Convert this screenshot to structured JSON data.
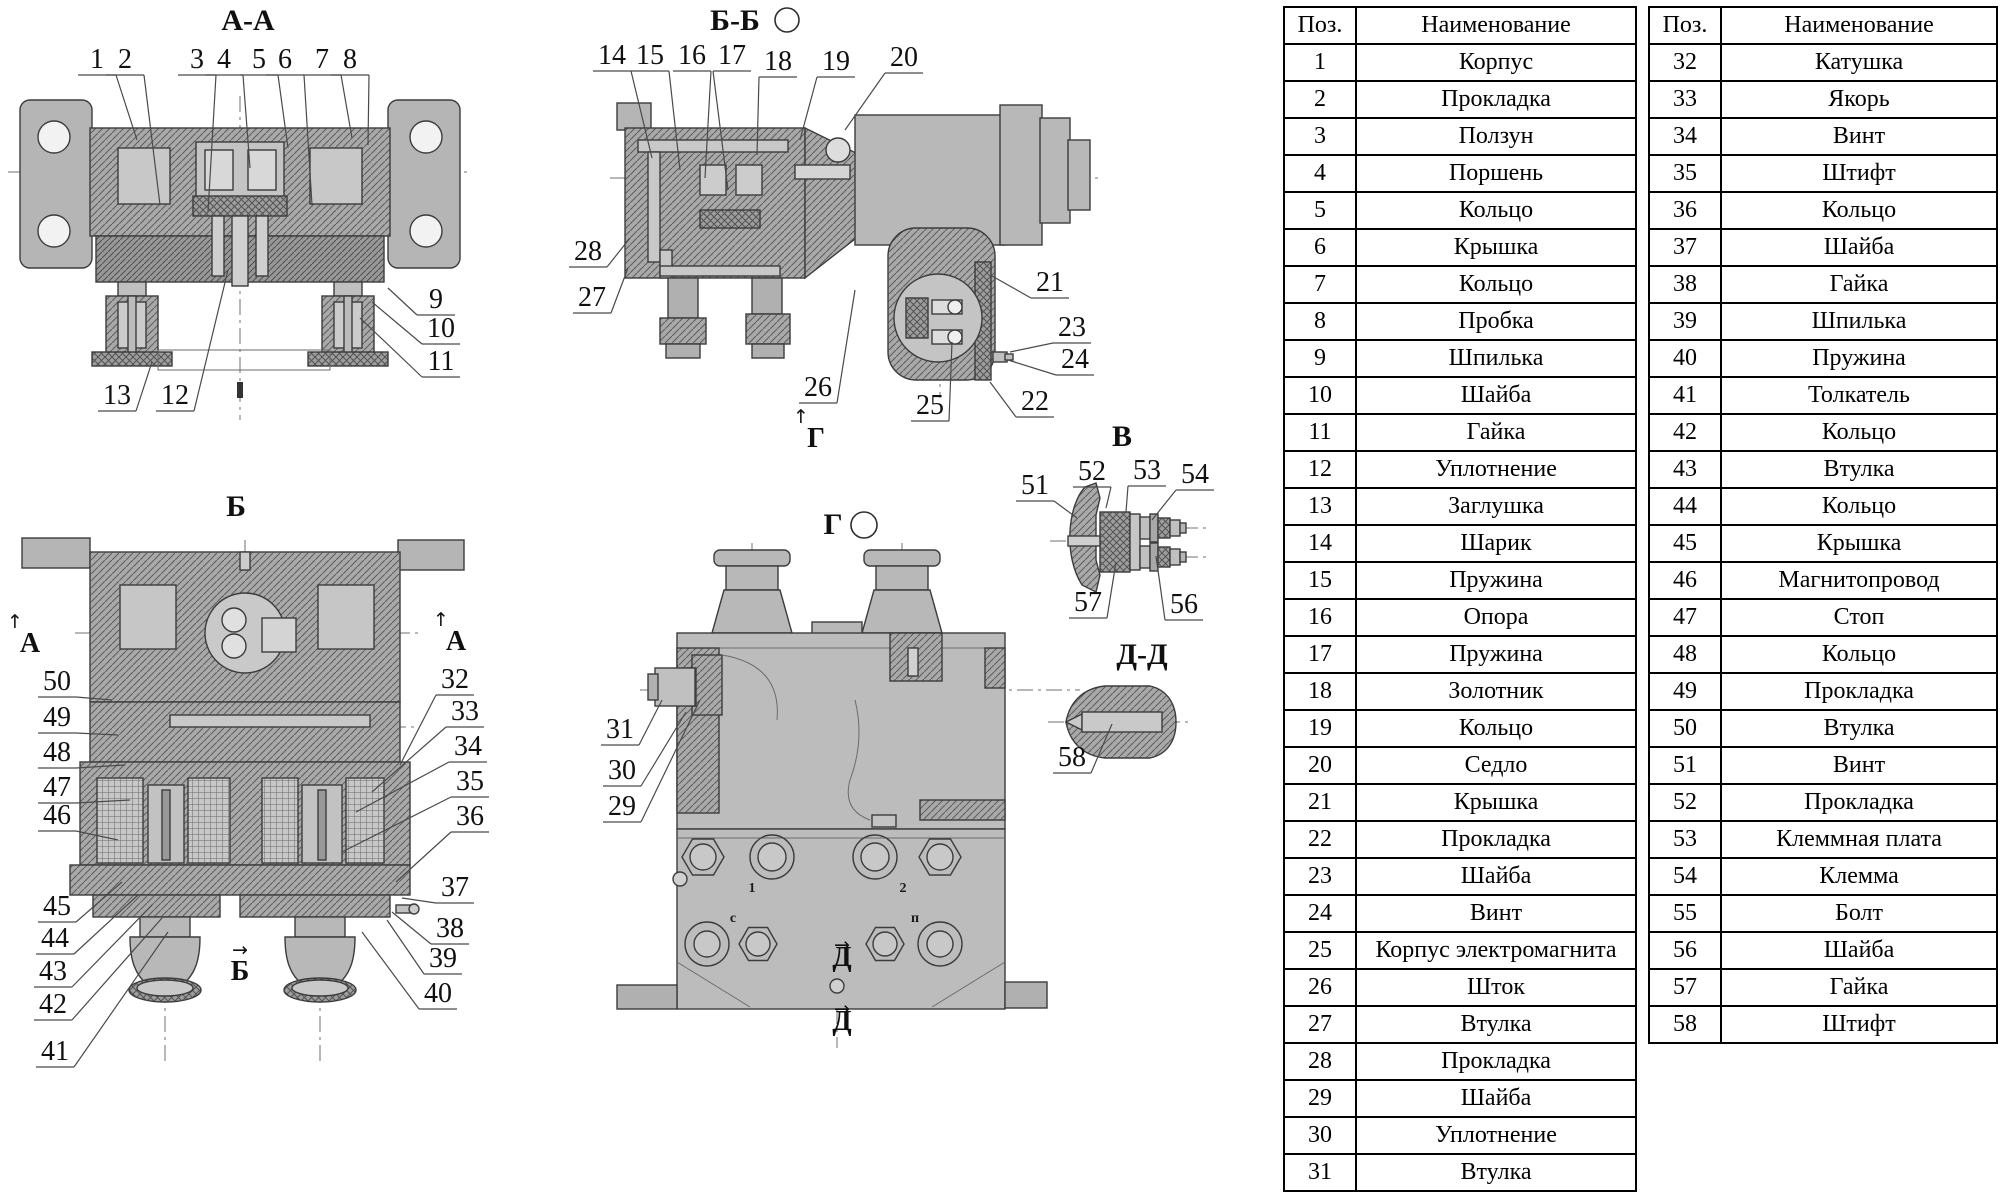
{
  "drawing": {
    "views": [
      {
        "id": "aa",
        "title": "А-А",
        "tx": 248,
        "ty": 30,
        "circle": null,
        "callouts": [
          {
            "n": "1",
            "x": 97,
            "y": 68,
            "px": 137,
            "py": 140
          },
          {
            "n": "2",
            "x": 125,
            "y": 68,
            "px": 160,
            "py": 205
          },
          {
            "n": "3",
            "x": 197,
            "y": 68,
            "px": 208,
            "py": 212
          },
          {
            "n": "4",
            "x": 224,
            "y": 68,
            "px": 250,
            "py": 168
          },
          {
            "n": "5",
            "x": 259,
            "y": 68,
            "px": 288,
            "py": 148
          },
          {
            "n": "6",
            "x": 285,
            "y": 68,
            "px": 312,
            "py": 205
          },
          {
            "n": "7",
            "x": 322,
            "y": 68,
            "px": 352,
            "py": 138
          },
          {
            "n": "8",
            "x": 350,
            "y": 68,
            "px": 368,
            "py": 145
          },
          {
            "n": "9",
            "x": 436,
            "y": 308,
            "px": 388,
            "py": 288
          },
          {
            "n": "10",
            "x": 441,
            "y": 337,
            "px": 372,
            "py": 302
          },
          {
            "n": "11",
            "x": 441,
            "y": 370,
            "px": 360,
            "py": 318
          },
          {
            "n": "13",
            "x": 117,
            "y": 404,
            "px": 152,
            "py": 362
          },
          {
            "n": "12",
            "x": 175,
            "y": 404,
            "px": 228,
            "py": 270
          }
        ]
      },
      {
        "id": "bb",
        "title": "Б-Б",
        "tx": 735,
        "ty": 30,
        "circle": {
          "x": 787,
          "y": 20,
          "r": 12
        },
        "callouts": [
          {
            "n": "14",
            "x": 612,
            "y": 64,
            "px": 652,
            "py": 158
          },
          {
            "n": "15",
            "x": 650,
            "y": 64,
            "px": 680,
            "py": 170
          },
          {
            "n": "16",
            "x": 692,
            "y": 64,
            "px": 705,
            "py": 178
          },
          {
            "n": "17",
            "x": 732,
            "y": 64,
            "px": 728,
            "py": 190
          },
          {
            "n": "18",
            "x": 778,
            "y": 70,
            "px": 757,
            "py": 155
          },
          {
            "n": "19",
            "x": 836,
            "y": 70,
            "px": 800,
            "py": 140
          },
          {
            "n": "20",
            "x": 904,
            "y": 66,
            "px": 845,
            "py": 130
          },
          {
            "n": "28",
            "x": 588,
            "y": 260,
            "px": 630,
            "py": 238
          },
          {
            "n": "27",
            "x": 592,
            "y": 306,
            "px": 628,
            "py": 268
          },
          {
            "n": "21",
            "x": 1050,
            "y": 291,
            "px": 992,
            "py": 276
          },
          {
            "n": "23",
            "x": 1072,
            "y": 336,
            "px": 1010,
            "py": 352
          },
          {
            "n": "24",
            "x": 1075,
            "y": 368,
            "px": 1008,
            "py": 360
          },
          {
            "n": "22",
            "x": 1035,
            "y": 410,
            "px": 990,
            "py": 382
          },
          {
            "n": "26",
            "x": 818,
            "y": 396,
            "px": 855,
            "py": 290
          },
          {
            "n": "25",
            "x": 930,
            "y": 414,
            "px": 952,
            "py": 342
          }
        ]
      },
      {
        "id": "b",
        "title": "Б",
        "tx": 236,
        "ty": 516,
        "circle": null,
        "callouts": [
          {
            "n": "50",
            "x": 57,
            "y": 690,
            "px": 112,
            "py": 700
          },
          {
            "n": "49",
            "x": 57,
            "y": 726,
            "px": 118,
            "py": 735
          },
          {
            "n": "48",
            "x": 57,
            "y": 761,
            "px": 125,
            "py": 765
          },
          {
            "n": "47",
            "x": 57,
            "y": 796,
            "px": 130,
            "py": 800
          },
          {
            "n": "46",
            "x": 57,
            "y": 824,
            "px": 118,
            "py": 840
          },
          {
            "n": "45",
            "x": 57,
            "y": 915,
            "px": 122,
            "py": 882
          },
          {
            "n": "44",
            "x": 55,
            "y": 947,
            "px": 138,
            "py": 895
          },
          {
            "n": "43",
            "x": 53,
            "y": 980,
            "px": 152,
            "py": 905
          },
          {
            "n": "42",
            "x": 53,
            "y": 1013,
            "px": 162,
            "py": 918
          },
          {
            "n": "41",
            "x": 55,
            "y": 1060,
            "px": 168,
            "py": 932
          },
          {
            "n": "32",
            "x": 455,
            "y": 688,
            "px": 400,
            "py": 765
          },
          {
            "n": "33",
            "x": 465,
            "y": 720,
            "px": 372,
            "py": 792
          },
          {
            "n": "34",
            "x": 468,
            "y": 755,
            "px": 356,
            "py": 812
          },
          {
            "n": "35",
            "x": 470,
            "y": 790,
            "px": 342,
            "py": 852
          },
          {
            "n": "36",
            "x": 470,
            "y": 825,
            "px": 396,
            "py": 882
          },
          {
            "n": "37",
            "x": 455,
            "y": 896,
            "px": 402,
            "py": 898
          },
          {
            "n": "38",
            "x": 450,
            "y": 937,
            "px": 392,
            "py": 912
          },
          {
            "n": "39",
            "x": 443,
            "y": 967,
            "px": 387,
            "py": 920
          },
          {
            "n": "40",
            "x": 438,
            "y": 1002,
            "px": 362,
            "py": 932
          }
        ]
      },
      {
        "id": "g",
        "title": "Г",
        "tx": 833,
        "ty": 534,
        "circle": {
          "x": 864,
          "y": 525,
          "r": 13
        },
        "callouts": [
          {
            "n": "31",
            "x": 620,
            "y": 738,
            "px": 662,
            "py": 700
          },
          {
            "n": "30",
            "x": 622,
            "y": 779,
            "px": 686,
            "py": 712
          },
          {
            "n": "29",
            "x": 622,
            "y": 815,
            "px": 700,
            "py": 700
          }
        ]
      },
      {
        "id": "v",
        "title": "В",
        "tx": 1122,
        "ty": 446,
        "circle": null,
        "callouts": [
          {
            "n": "51",
            "x": 1035,
            "y": 494,
            "px": 1077,
            "py": 518
          },
          {
            "n": "52",
            "x": 1092,
            "y": 480,
            "px": 1106,
            "py": 508
          },
          {
            "n": "53",
            "x": 1147,
            "y": 479,
            "px": 1126,
            "py": 512
          },
          {
            "n": "54",
            "x": 1195,
            "y": 483,
            "px": 1152,
            "py": 520
          },
          {
            "n": "57",
            "x": 1088,
            "y": 611,
            "px": 1116,
            "py": 562
          },
          {
            "n": "56",
            "x": 1184,
            "y": 613,
            "px": 1156,
            "py": 556
          }
        ]
      },
      {
        "id": "dd",
        "title": "Д-Д",
        "tx": 1142,
        "ty": 664,
        "circle": null,
        "callouts": [
          {
            "n": "58",
            "x": 1072,
            "y": 766,
            "px": 1112,
            "py": 724
          }
        ]
      }
    ],
    "markers": [
      {
        "label": "А",
        "x": 30,
        "y": 652,
        "dir": "up",
        "size": 28
      },
      {
        "label": "А",
        "x": 456,
        "y": 650,
        "dir": "up",
        "size": 28
      },
      {
        "label": "Б",
        "x": 240,
        "y": 980,
        "dir": "right",
        "size": 28
      },
      {
        "label": "Г",
        "x": 816,
        "y": 447,
        "dir": "up",
        "size": 28
      },
      {
        "label": "Д",
        "x": 842,
        "y": 966,
        "dir": "right",
        "size": 19
      },
      {
        "label": "Д",
        "x": 842,
        "y": 1030,
        "dir": "right",
        "size": 19
      }
    ],
    "port_labels": [
      {
        "t": "1",
        "x": 752,
        "y": 892
      },
      {
        "t": "2",
        "x": 903,
        "y": 892
      },
      {
        "t": "с",
        "x": 733,
        "y": 922
      },
      {
        "t": "п",
        "x": 915,
        "y": 922
      }
    ]
  },
  "tables": [
    {
      "headers": {
        "pos": "Поз.",
        "name": "Наименование"
      },
      "rows": [
        [
          "1",
          "Корпус"
        ],
        [
          "2",
          "Прокладка"
        ],
        [
          "3",
          "Ползун"
        ],
        [
          "4",
          "Поршень"
        ],
        [
          "5",
          "Кольцо"
        ],
        [
          "6",
          "Крышка"
        ],
        [
          "7",
          "Кольцо"
        ],
        [
          "8",
          "Пробка"
        ],
        [
          "9",
          "Шпилька"
        ],
        [
          "10",
          "Шайба"
        ],
        [
          "11",
          "Гайка"
        ],
        [
          "12",
          "Уплотнение"
        ],
        [
          "13",
          "Заглушка"
        ],
        [
          "14",
          "Шарик"
        ],
        [
          "15",
          "Пружина"
        ],
        [
          "16",
          "Опора"
        ],
        [
          "17",
          "Пружина"
        ],
        [
          "18",
          "Золотник"
        ],
        [
          "19",
          "Кольцо"
        ],
        [
          "20",
          "Седло"
        ],
        [
          "21",
          "Крышка"
        ],
        [
          "22",
          "Прокладка"
        ],
        [
          "23",
          "Шайба"
        ],
        [
          "24",
          "Винт"
        ],
        [
          "25",
          "Корпус электромагнита"
        ],
        [
          "26",
          "Шток"
        ],
        [
          "27",
          "Втулка"
        ],
        [
          "28",
          "Прокладка"
        ],
        [
          "29",
          "Шайба"
        ],
        [
          "30",
          "Уплотнение"
        ],
        [
          "31",
          "Втулка"
        ]
      ]
    },
    {
      "headers": {
        "pos": "Поз.",
        "name": "Наименование"
      },
      "rows": [
        [
          "32",
          "Катушка"
        ],
        [
          "33",
          "Якорь"
        ],
        [
          "34",
          "Винт"
        ],
        [
          "35",
          "Штифт"
        ],
        [
          "36",
          "Кольцо"
        ],
        [
          "37",
          "Шайба"
        ],
        [
          "38",
          "Гайка"
        ],
        [
          "39",
          "Шпилька"
        ],
        [
          "40",
          "Пружина"
        ],
        [
          "41",
          "Толкатель"
        ],
        [
          "42",
          "Кольцо"
        ],
        [
          "43",
          "Втулка"
        ],
        [
          "44",
          "Кольцо"
        ],
        [
          "45",
          "Крышка"
        ],
        [
          "46",
          "Магнитопровод"
        ],
        [
          "47",
          "Стоп"
        ],
        [
          "48",
          "Кольцо"
        ],
        [
          "49",
          "Прокладка"
        ],
        [
          "50",
          "Втулка"
        ],
        [
          "51",
          "Винт"
        ],
        [
          "52",
          "Прокладка"
        ],
        [
          "53",
          "Клеммная плата"
        ],
        [
          "54",
          "Клемма"
        ],
        [
          "55",
          "Болт"
        ],
        [
          "56",
          "Шайба"
        ],
        [
          "57",
          "Гайка"
        ],
        [
          "58",
          "Штифт"
        ]
      ]
    }
  ]
}
